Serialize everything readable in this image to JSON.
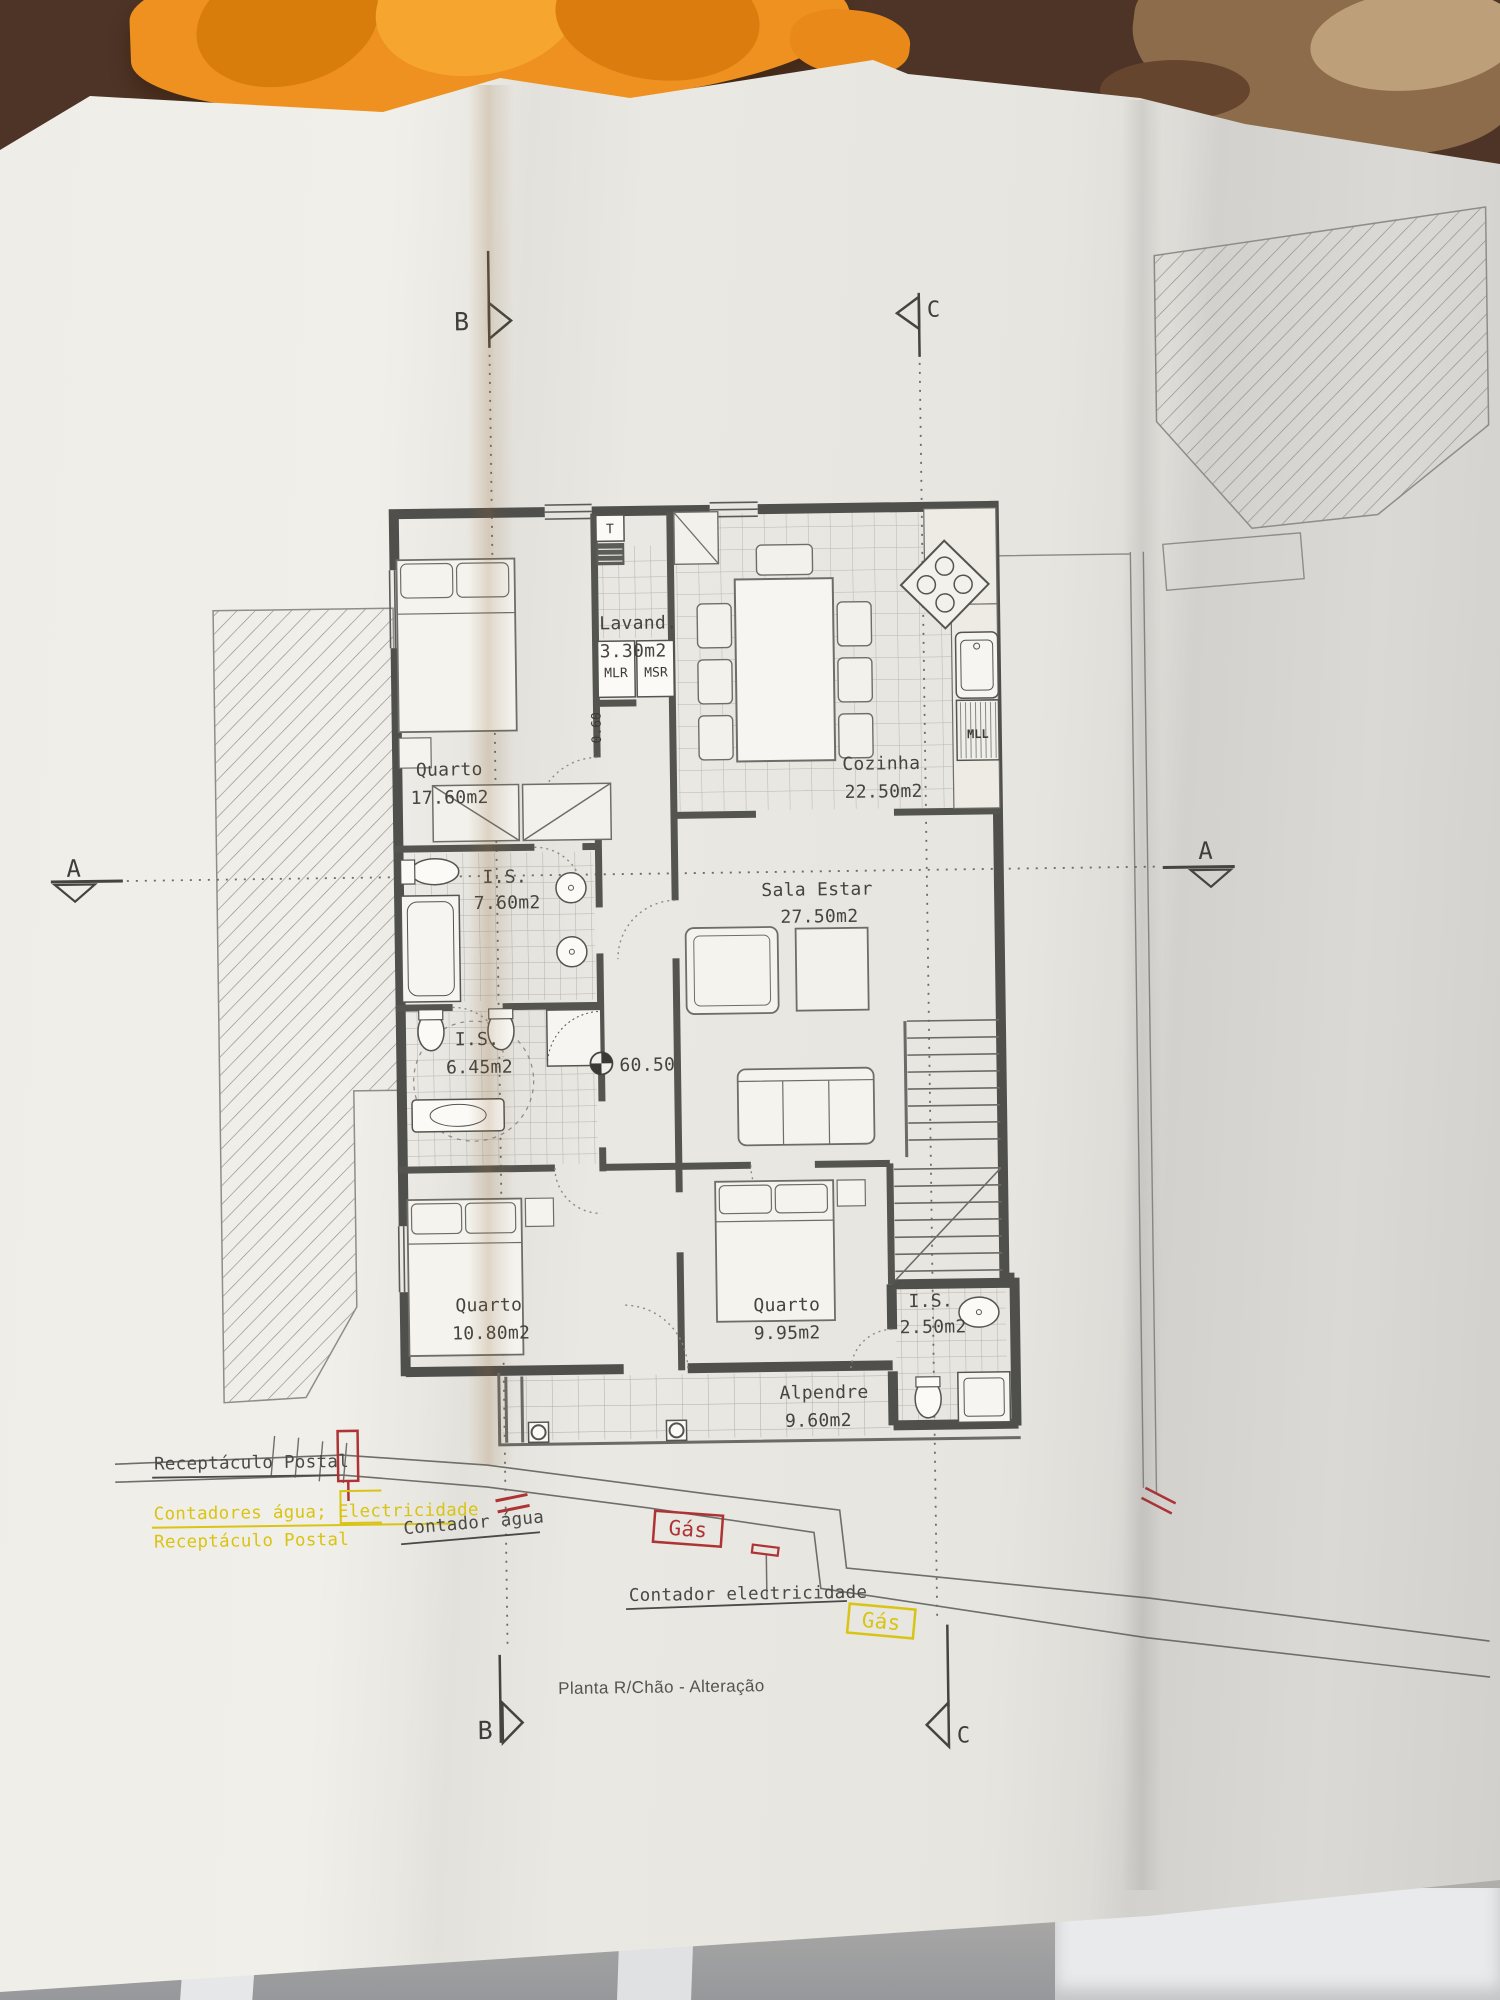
{
  "plan": {
    "title": "Planta R/Chão - Alteração",
    "rooms": [
      {
        "name": "Quarto",
        "area": "17.60m2"
      },
      {
        "name": "Lavand.",
        "area": "3.30m2"
      },
      {
        "name": "Cozinha",
        "area": "22.50m2"
      },
      {
        "name": "I.S.",
        "area": "7.60m2"
      },
      {
        "name": "Sala Estar",
        "area": "27.50m2"
      },
      {
        "name": "I.S.",
        "area": "6.45m2"
      },
      {
        "name": "Quarto",
        "area": "10.80m2"
      },
      {
        "name": "Quarto",
        "area": "9.95m2"
      },
      {
        "name": "I.S.",
        "area": "2.50m2"
      },
      {
        "name": "Alpendre",
        "area": "9.60m2"
      }
    ],
    "appliances": {
      "water_heater": "T",
      "washer": "MLR",
      "dryer": "MSR",
      "dishwasher": "MLL"
    },
    "levels": {
      "floor_level": "60.50",
      "step": "0.60"
    },
    "sections": {
      "a": "A",
      "b": "B",
      "c": "C"
    },
    "site_labels": {
      "postal_gray": "Receptáculo Postal",
      "meters_yellow": "Contadores água; Electricidade",
      "postal_yellow": "Receptáculo Postal",
      "water_meter": "Contador água",
      "gas_box_red": "Gás",
      "electricity_meter": "Contador electricidade",
      "gas_box_yellow": "Gás"
    },
    "ink": {
      "line": "#4b4b48",
      "red": "#ae3335",
      "yellow": "#d9c414",
      "paper": "#e9e7e1"
    }
  }
}
